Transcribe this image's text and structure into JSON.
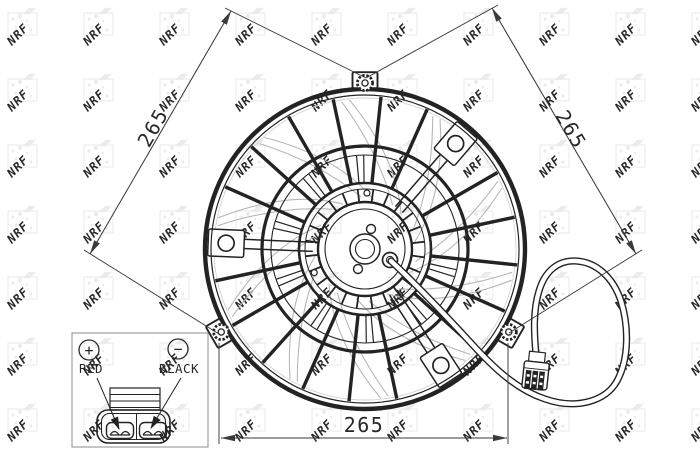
{
  "watermark": {
    "text": "NRF"
  },
  "dimensions": {
    "left": "265",
    "right": "265",
    "bottom": "265"
  },
  "legend": {
    "positive_symbol": "+",
    "negative_symbol": "−",
    "positive_label": "RED",
    "negative_label": "BLACK"
  },
  "colors": {
    "ink": "#232323",
    "dimension": "#3a3a3a",
    "blade": "#b7b7b7",
    "blade_tip": "#d4d4d4",
    "watermark": "#ebebeb",
    "background": "#ffffff"
  }
}
